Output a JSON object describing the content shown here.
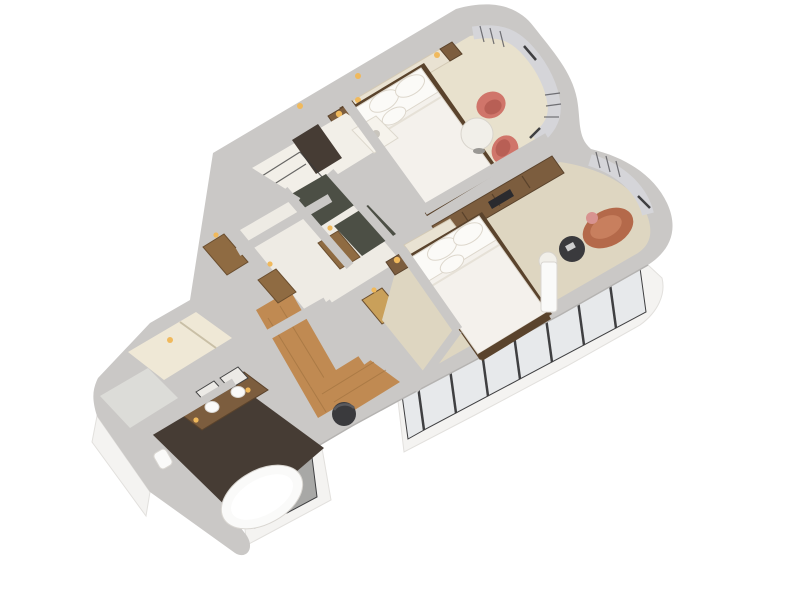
{
  "background": "#ffffff",
  "scene": {
    "type": "3d-isometric-floor-plan-render",
    "subject": "hotel-suite-cutaway"
  },
  "colors": {
    "background": "#ffffff",
    "wall_cap": "#cac8c6",
    "wall_cap_shade": "#b5b3b1",
    "wall_face": "#f4f3f1",
    "wall_face_shade": "#e2e0dd",
    "carpet": "#ded6c1",
    "carpet_light": "#e8e1cd",
    "wood_floor": "#c08a52",
    "wood_floor_dark": "#9c6f3d",
    "door_wood": "#8f6b42",
    "door_wood_dark": "#6a4e2f",
    "door_lit": "#c9a05a",
    "furniture_wood": "#7c5d3e",
    "furniture_wood_dark": "#5a432c",
    "bed_linen": "#f4f1ec",
    "bed_linen_shade": "#ddd7cc",
    "headboard_panel": "#e9e2d2",
    "chair_coral": "#d0756a",
    "chair_coral_dark": "#b85f55",
    "sofa_terracotta": "#b4694a",
    "sofa_terracotta_light": "#c87f5e",
    "pillow_pink": "#d89390",
    "chair_charcoal": "#3a3a3d",
    "table_white": "#f1efe9",
    "tile_dark": "#463c34",
    "tile_green_dark": "#4c4f45",
    "porcelain": "#fafaf9",
    "glass": "#e7e9eb",
    "glass_shade": "#a8a8a6",
    "mullion": "#3f3f41",
    "curtain": "#d5d5d9",
    "curtain_stripe": "#55555a",
    "lamp_glow": "#f0b95c",
    "niche_cream": "#efe8d6"
  }
}
